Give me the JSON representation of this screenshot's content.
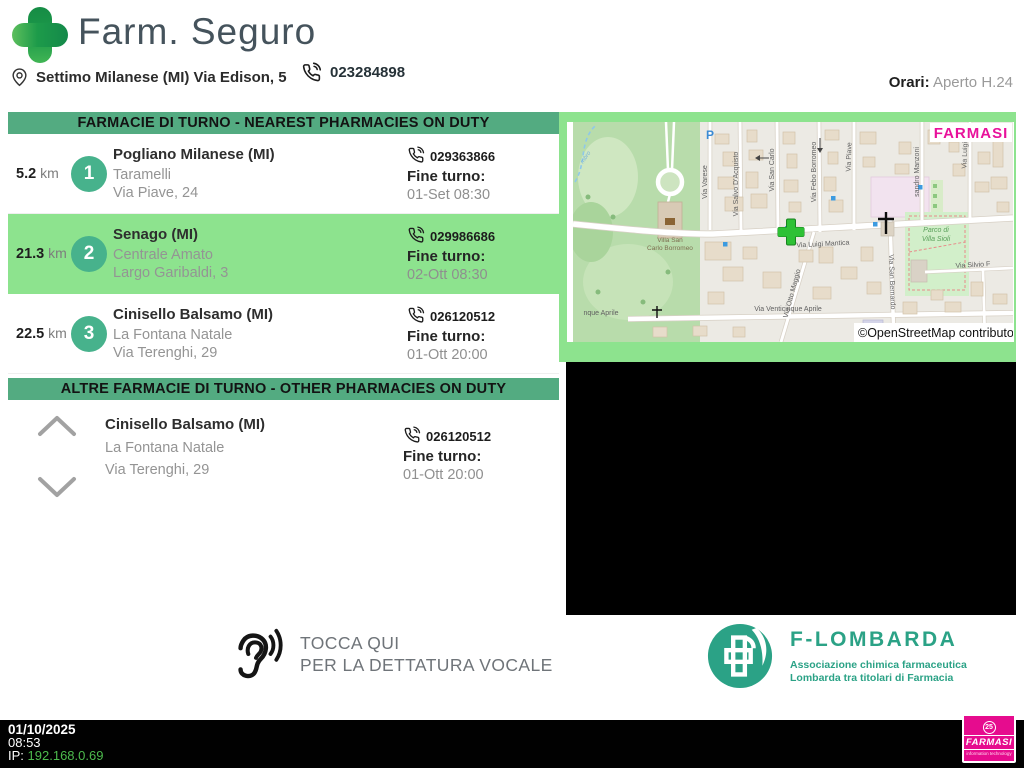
{
  "header": {
    "title": "Farm. Seguro",
    "address": "Settimo Milanese (MI) Via Edison, 5",
    "phone": "023284898",
    "hours_label": "Orari:",
    "hours_value": "Aperto H.24"
  },
  "panel": {
    "nearest_title": "FARMACIE DI TURNO - NEAREST PHARMACIES ON DUTY",
    "other_title": "ALTRE FARMACIE DI TURNO - OTHER PHARMACIES ON DUTY",
    "fine_turno_label": "Fine turno:",
    "rows": [
      {
        "distance": "5.2",
        "unit": "km",
        "rank": "1",
        "city": "Pogliano Milanese (MI)",
        "name": "Taramelli",
        "street": "Via Piave, 24",
        "phone": "029363866",
        "fine_turno_label": "Fine turno:",
        "fine_turno": "01-Set 08:30"
      },
      {
        "distance": "21.3",
        "unit": "km",
        "rank": "2",
        "city": "Senago (MI)",
        "name": "Centrale Amato",
        "street": "Largo Garibaldi, 3",
        "phone": "029986686",
        "fine_turno_label": "Fine turno:",
        "fine_turno": "02-Ott 08:30"
      },
      {
        "distance": "22.5",
        "unit": "km",
        "rank": "3",
        "city": "Cinisello Balsamo (MI)",
        "name": "La Fontana Natale",
        "street": "Via Terenghi, 29",
        "phone": "026120512",
        "fine_turno_label": "Fine turno:",
        "fine_turno": "01-Ott 20:00"
      }
    ],
    "other_rows": [
      {
        "city": "Cinisello Balsamo (MI)",
        "name": "La Fontana Natale",
        "street": "Via Terenghi, 29",
        "phone": "026120512",
        "fine_turno_label": "Fine turno:",
        "fine_turno": "01-Ott 20:00"
      }
    ]
  },
  "map": {
    "watermark": "FARMASI",
    "attribution": "©OpenStreetMap contributors",
    "parking": "P",
    "labels": {
      "stream": "mbro",
      "villa1": "Villa San",
      "villa2": "Carlo Borromeo",
      "parco1": "Parco di",
      "parco2": "Villa Sioli",
      "varese": "Via Varese",
      "acquisto": "Via Salvo D'Acquisto",
      "sancarlo": "Via San Carlo",
      "borromeo": "Via Febo Borromeo",
      "piave": "Via Piave",
      "manzoni": "sandro Manzoni",
      "luigica": "Via Luigi Ca",
      "mantica": "Via Luigi Mantica",
      "ottomaggio": "Via Otto Maggio",
      "bernardo": "Via San Bernardo",
      "venticinque": "Via Venticinque Aprile",
      "venticinque_partial": "nque Aprile",
      "silvio": "Via Silvio F"
    }
  },
  "voice": {
    "line1": "TOCCA QUI",
    "line2": "PER LA DETTATURA VOCALE"
  },
  "flombarda": {
    "name": "F-LOMBARDA",
    "subtitle1": "Associazione chimica farmaceutica",
    "subtitle2": "Lombarda tra titolari di Farmacia"
  },
  "footer": {
    "date": "01/10/2025",
    "time": "08:53",
    "ip_label": "IP:",
    "ip": "192.168.0.69",
    "logo_badge": "25",
    "logo_text": "FARMASI",
    "logo_sub": "information technology"
  },
  "colors": {
    "accent_green": "#53ab81",
    "highlight_green": "#8de38e",
    "badge_green": "#47b28c",
    "brand_magenta": "#e60c8e",
    "flombarda_teal": "#2ba286",
    "ip_green": "#4dbb4d"
  }
}
